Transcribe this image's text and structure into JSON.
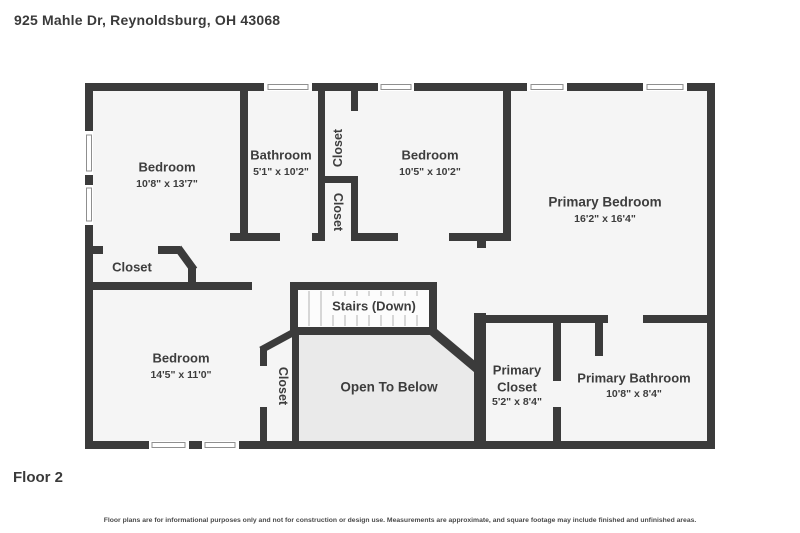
{
  "header": {
    "address": "925 Mahle Dr, Reynoldsburg, OH 43068"
  },
  "footer": {
    "floor_label": "Floor 2",
    "disclaimer": "Floor plans are for informational purposes only and not for construction or design use. Measurements are approximate, and square footage may include finished and unfinished areas."
  },
  "colors": {
    "wall": "#3b3b3b",
    "room_fill": "#f5f5f5",
    "open_to_below_fill": "#eaeaea",
    "stairs_fill": "#fcfcfc",
    "text": "#3d3d3d"
  },
  "rooms": {
    "bedroom1": {
      "name": "Bedroom",
      "dims": "10'8\" x 13'7\""
    },
    "bathroom": {
      "name": "Bathroom",
      "dims": "5'1\" x 10'2\""
    },
    "closet_top": {
      "name": "Closet"
    },
    "bedroom2": {
      "name": "Bedroom",
      "dims": "10'5\" x 10'2\""
    },
    "primary_bedroom": {
      "name": "Primary Bedroom",
      "dims": "16'2\" x 16'4\""
    },
    "closet_mid": {
      "name": "Closet"
    },
    "closet_hall": {
      "name": "Closet"
    },
    "stairs": {
      "name": "Stairs (Down)"
    },
    "bedroom3": {
      "name": "Bedroom",
      "dims": "14'5\" x 11'0\""
    },
    "closet_bedroom3": {
      "name": "Closet"
    },
    "open_to_below": {
      "name": "Open To Below"
    },
    "primary_closet": {
      "line1": "Primary",
      "line2": "Closet",
      "dims": "5'2\" x 8'4\""
    },
    "primary_bathroom": {
      "name": "Primary Bathroom",
      "dims": "10'8\" x 8'4\""
    }
  }
}
